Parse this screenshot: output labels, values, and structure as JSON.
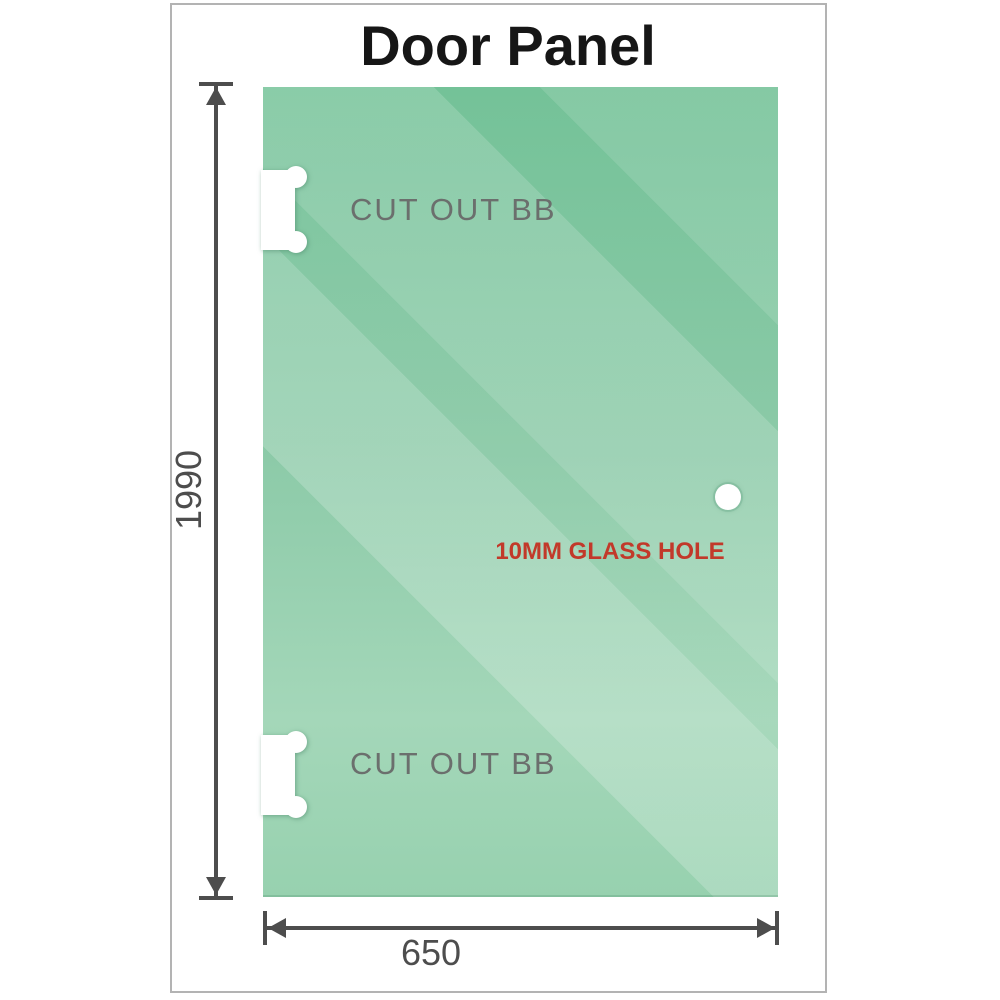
{
  "page": {
    "title": "Door Panel"
  },
  "panel": {
    "cutouts": [
      {
        "label": "CUT OUT BB"
      },
      {
        "label": "CUT OUT BB"
      }
    ],
    "glass_hole": {
      "label": "10MM GLASS HOLE"
    }
  },
  "dimensions": {
    "height": {
      "value": "1990"
    },
    "width": {
      "value": "650"
    }
  },
  "colors": {
    "glass_green_top": "#74c298",
    "glass_green_bottom": "#a4d7b9",
    "dimension_gray": "#4d4d4d",
    "cutout_label_gray": "#6b6f6d",
    "annotation_red": "#c2392a",
    "frame_border_gray": "#b3b3b3",
    "title_black": "#161616"
  },
  "icons": {
    "up_arrow": "css-triangle-up",
    "down_arrow": "css-triangle-down",
    "left_arrow": "css-triangle-left",
    "right_arrow": "css-triangle-right",
    "glass_hole": "css-circle",
    "hinge_cutout": "white-rect-with-two-bumps"
  }
}
